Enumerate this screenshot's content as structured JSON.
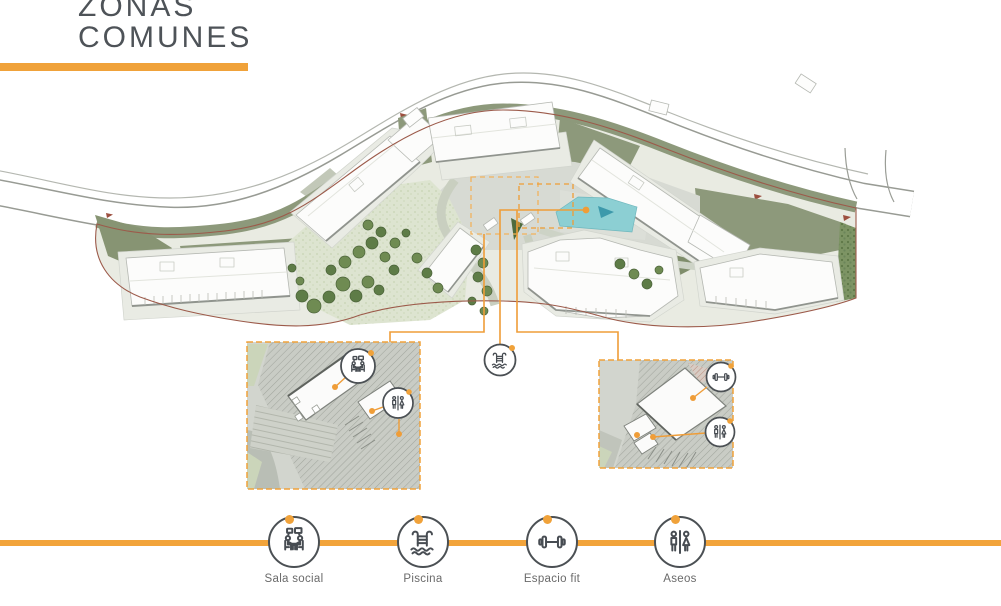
{
  "title": {
    "line1": "ZONAS",
    "line2": "COMUNES"
  },
  "legend": {
    "items": [
      {
        "id": "sala-social",
        "label": "Sala social",
        "icon": "meeting-people-icon"
      },
      {
        "id": "piscina",
        "label": "Piscina",
        "icon": "pool-ladder-icon"
      },
      {
        "id": "espacio-fit",
        "label": "Espacio fit",
        "icon": "dumbbell-icon"
      },
      {
        "id": "aseos",
        "label": "Aseos",
        "icon": "wc-figures-icon"
      }
    ]
  },
  "plan": {
    "callouts": [
      {
        "id": "piscina-marker",
        "icon": "pool-ladder-icon"
      },
      {
        "id": "sala-social-marker",
        "icon": "meeting-people-icon"
      },
      {
        "id": "aseos-left-marker",
        "icon": "wc-figures-icon"
      },
      {
        "id": "espacio-fit-marker",
        "icon": "dumbbell-icon"
      },
      {
        "id": "aseos-right-marker",
        "icon": "wc-figures-icon"
      }
    ],
    "insets": [
      {
        "id": "sala-social-detail"
      },
      {
        "id": "espacio-fit-detail"
      }
    ]
  },
  "colors": {
    "accent_orange": "#F0A23A",
    "title_gray": "#4E5358",
    "label_gray": "#6A6A6A",
    "pool_teal": "#8CCFD3",
    "sage_green": "#8D997B",
    "boundary_brown": "#9C5A4A"
  }
}
